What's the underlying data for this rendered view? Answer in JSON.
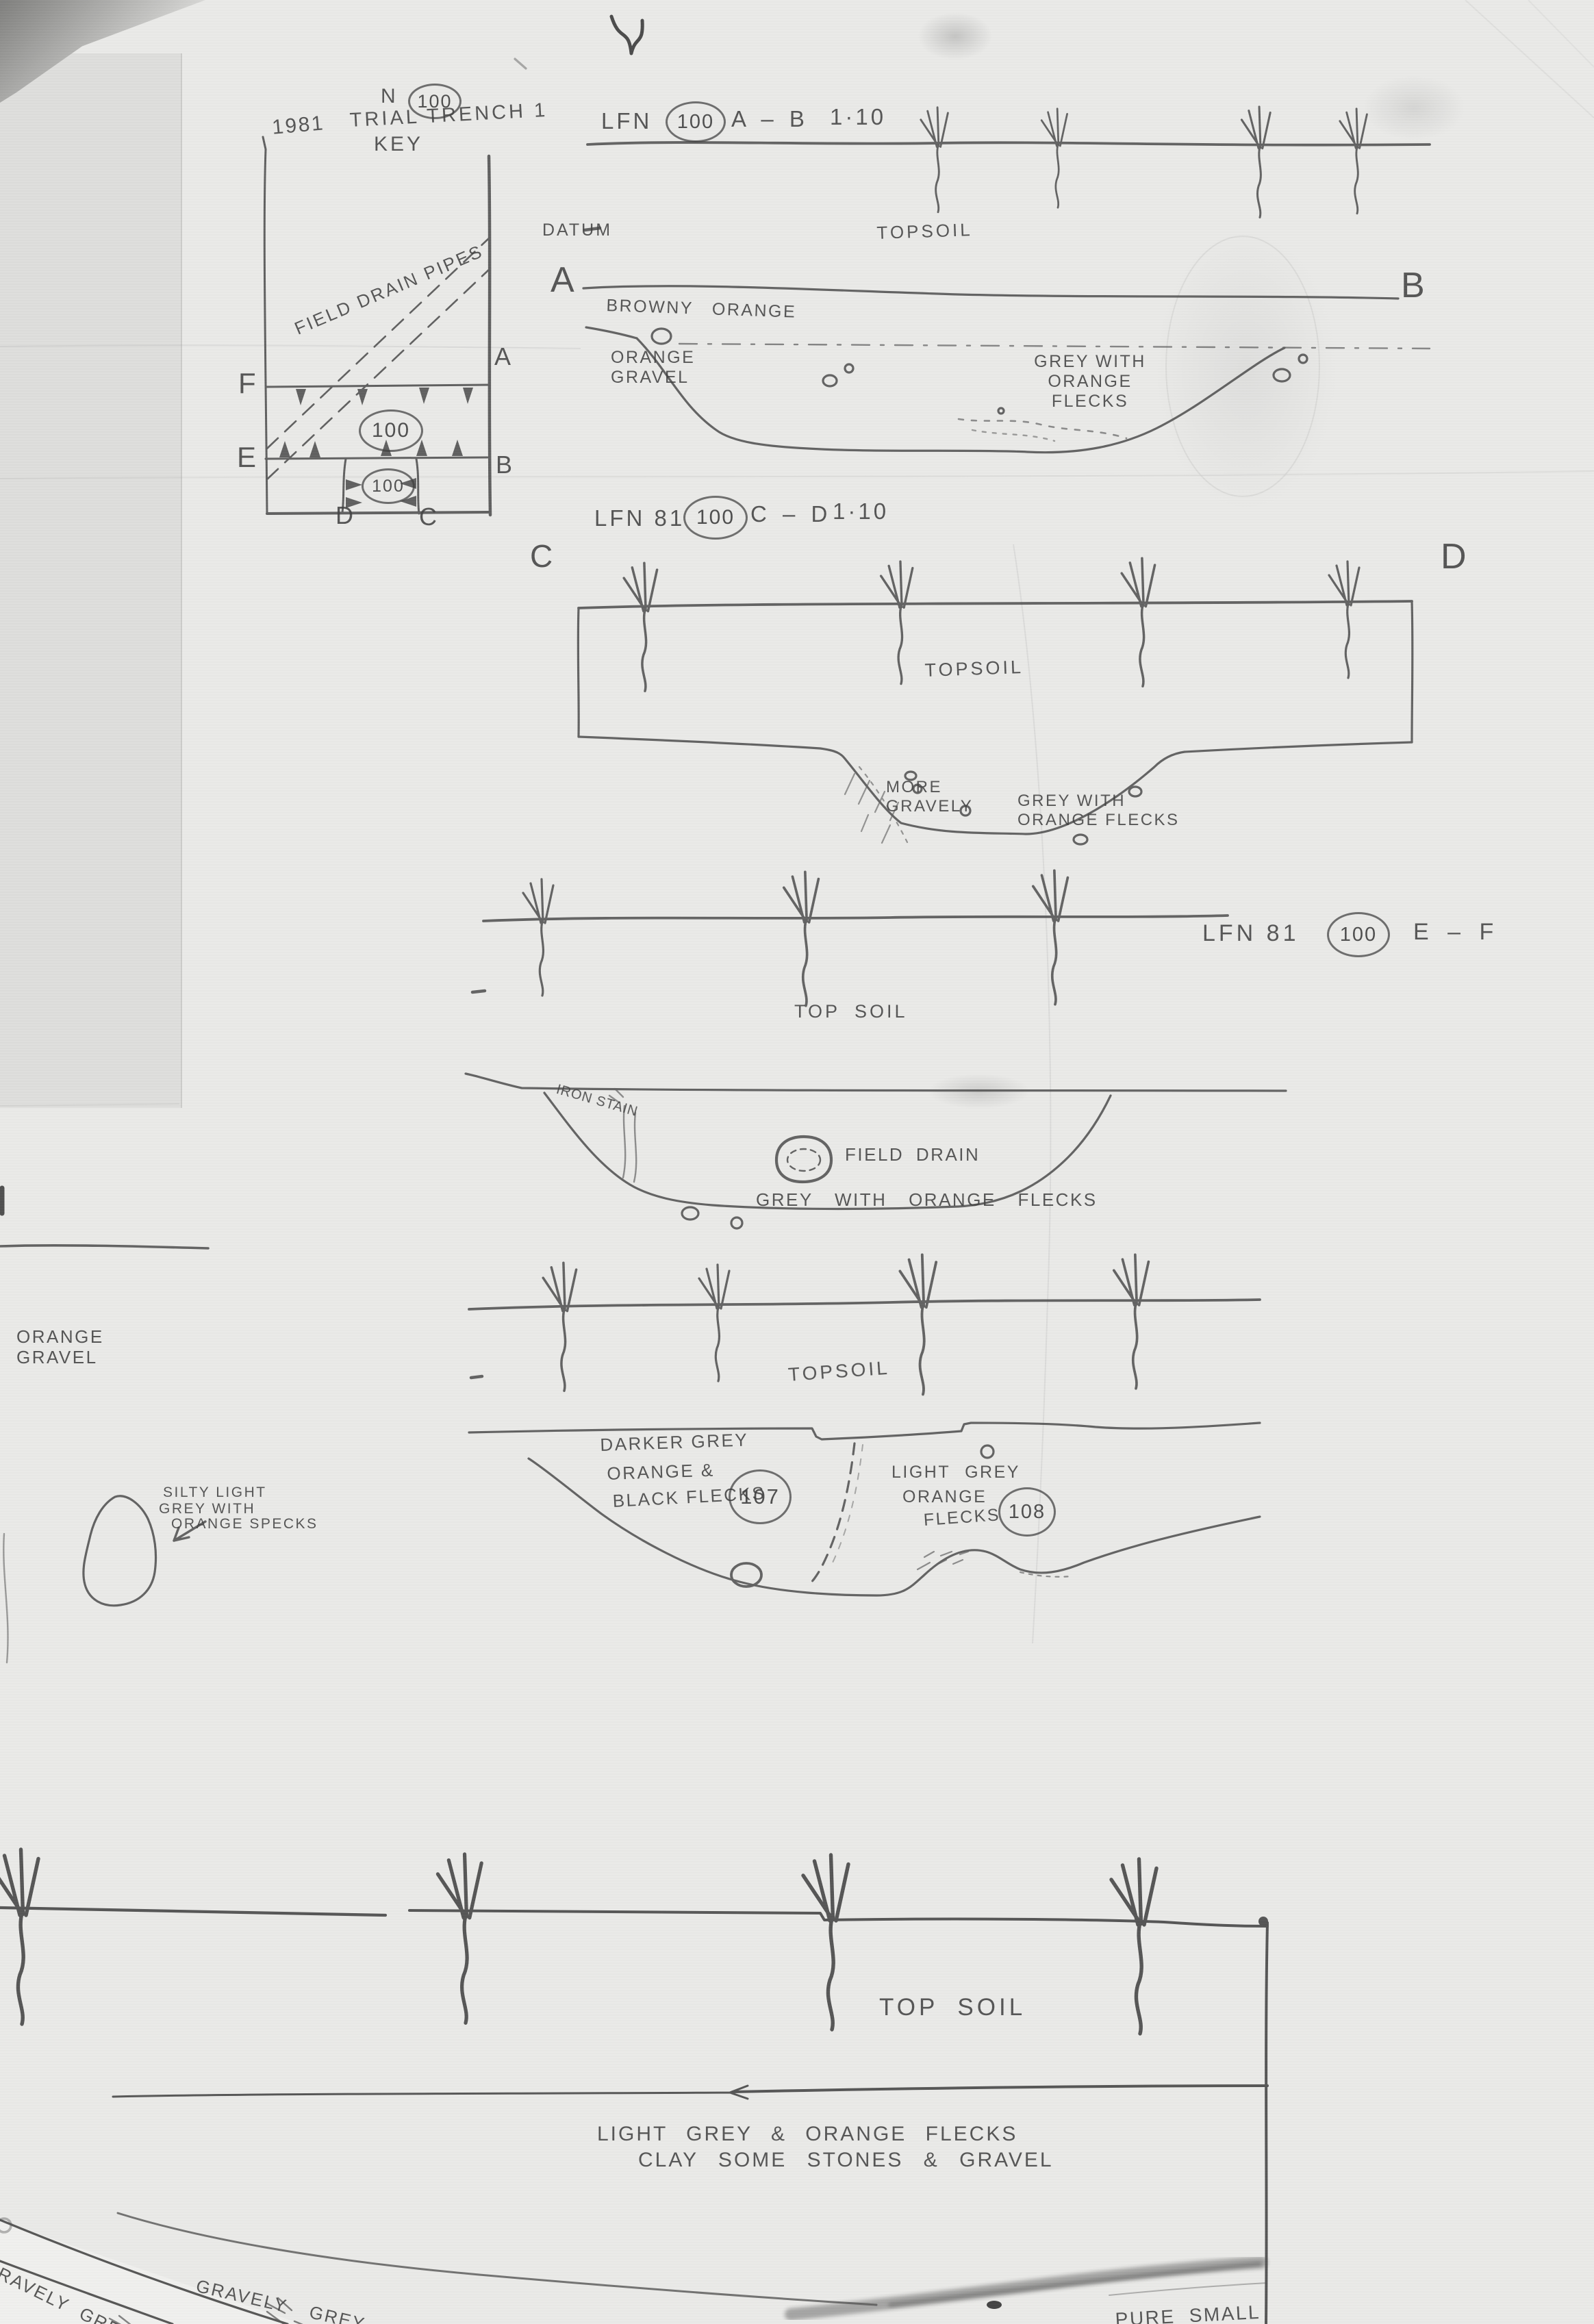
{
  "key_plan": {
    "north": "N",
    "context": "100",
    "year": "1981",
    "title": "TRIAL TRENCH 1",
    "subtitle": "KEY",
    "field_drain_pipes": "FIELD DRAIN PIPES",
    "context_upper": "100",
    "context_lower": "100",
    "corner_f": "F",
    "corner_a": "A",
    "corner_e": "E",
    "corner_b": "B",
    "corner_d": "D",
    "corner_c": "C"
  },
  "section_ab": {
    "site": "LFN",
    "context": "100",
    "span": "A – B",
    "scale": "1·10",
    "datum": "DATUM",
    "topsoil": "TOPSOIL",
    "end_left": "A",
    "end_right": "B",
    "layer_browny": "BROWNY ORANGE",
    "layer_orange_gravel": "ORANGE\nGRAVEL",
    "fill_grey": "GREY WITH ORANGE\nFLECKS"
  },
  "section_cd": {
    "site": "LFN 81",
    "context": "100",
    "span": "C – D",
    "scale": "1·10",
    "end_left": "C",
    "end_right": "D",
    "topsoil": "TOPSOIL",
    "more_gravely": "MORE\nGRAVELY",
    "fill_grey": "GREY WITH\nORANGE FLECKS"
  },
  "section_ef": {
    "site": "LFN 81",
    "context": "100",
    "span": "E – F",
    "topsoil": "TOP SOIL",
    "iron_stain": "IRON STAIN",
    "field_drain": "FIELD DRAIN",
    "fill_grey": "GREY WITH ORANGE FLECKS"
  },
  "section_107_108": {
    "topsoil": "TOPSOIL",
    "fill_107_line1": "DARKER GREY",
    "fill_107_line2": "ORANGE &",
    "fill_107_line3": "BLACK FLECKS",
    "context_107": "107",
    "fill_108_line1": "LIGHT GREY",
    "fill_108_line2": "ORANGE",
    "fill_108_line3": "FLECKS",
    "context_108": "108"
  },
  "left_margin": {
    "orange_gravel": "ORANGE\nGRAVEL",
    "silty_line1": "SILTY LIGHT",
    "silty_line2": "GREY WITH",
    "silty_line3": "ORANGE SPECKS"
  },
  "bottom_section": {
    "topsoil": "TOP SOIL",
    "layer_line1": "LIGHT GREY & ORANGE FLECKS",
    "layer_line2": "CLAY SOME STONES & GRAVEL",
    "fragment_left": "GRAVELY GREY",
    "fragment_mid": "GRAVELY GREY",
    "fragment_right": "PURE SMALL"
  }
}
